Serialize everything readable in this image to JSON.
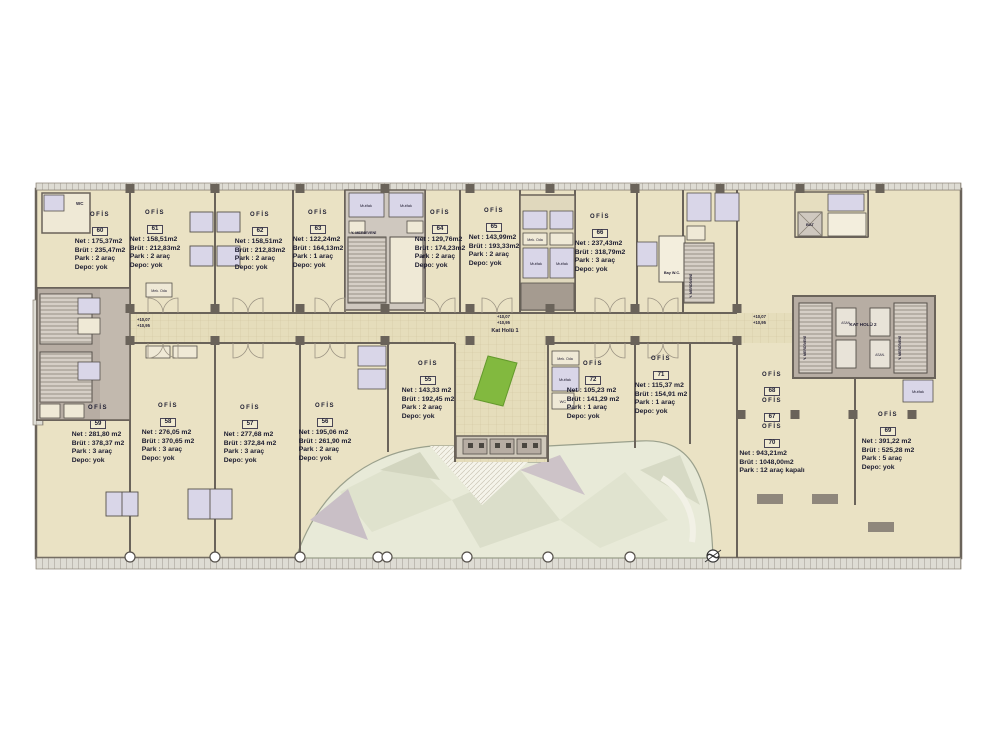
{
  "plan_name": "office-floor-plan",
  "offices": [
    {
      "title": "OFİS",
      "number": "60",
      "net": "Net : 175,37m2",
      "brut": "Brüt : 235,47m2",
      "park": "Park : 2 araç",
      "depo": "Depo: yok"
    },
    {
      "title": "OFİS",
      "number": "61",
      "net": "Net : 158,51m2",
      "brut": "Brüt : 212,83m2",
      "park": "Park : 2 araç",
      "depo": "Depo: yok"
    },
    {
      "title": "OFİS",
      "number": "62",
      "net": "Net : 158,51m2",
      "brut": "Brüt : 212,83m2",
      "park": "Park : 2 araç",
      "depo": "Depo: yok"
    },
    {
      "title": "OFİS",
      "number": "63",
      "net": "Net : 122,24m2",
      "brut": "Brüt : 164,13m2",
      "park": "Park : 1 araç",
      "depo": "Depo: yok"
    },
    {
      "title": "OFİS",
      "number": "64",
      "net": "Net : 129,76m2",
      "brut": "Brüt : 174,23m2",
      "park": "Park : 2 araç",
      "depo": "Depo: yok"
    },
    {
      "title": "OFİS",
      "number": "65",
      "net": "Net : 143,99m2",
      "brut": "Brüt : 193,33m2",
      "park": "Park : 2 araç",
      "depo": "Depo: yok"
    },
    {
      "title": "OFİS",
      "number": "66",
      "net": "Net : 237,43m2",
      "brut": "Brüt : 318,79m2",
      "park": "Park : 3 araç",
      "depo": "Depo: yok"
    },
    {
      "title": "OFİS",
      "number": "59",
      "net": "Net : 281,80 m2",
      "brut": "Brüt : 378,37 m2",
      "park": "Park : 3 araç",
      "depo": "Depo: yok"
    },
    {
      "title": "OFİS",
      "number": "58",
      "net": "Net : 276,05 m2",
      "brut": "Brüt : 370,65 m2",
      "park": "Park : 3 araç",
      "depo": "Depo: yok"
    },
    {
      "title": "OFİS",
      "number": "57",
      "net": "Net : 277,68 m2",
      "brut": "Brüt : 372,84 m2",
      "park": "Park : 3 araç",
      "depo": "Depo: yok"
    },
    {
      "title": "OFİS",
      "number": "56",
      "net": "Net : 195,06 m2",
      "brut": "Brüt : 261,90 m2",
      "park": "Park : 2 araç",
      "depo": "Depo: yok"
    },
    {
      "title": "OFİS",
      "number": "55",
      "net": "Net : 143,33 m2",
      "brut": "Brüt : 192,45 m2",
      "park": "Park : 2 araç",
      "depo": "Depo: yok"
    },
    {
      "title": "OFİS",
      "number": "72",
      "net": "Net : 105,23 m2",
      "brut": "Brüt : 141,29 m2",
      "park": "Park : 1 araç",
      "depo": "Depo: yok"
    },
    {
      "title": "OFİS",
      "number": "71",
      "net": "Net : 115,37 m2",
      "brut": "Brüt : 154,91 m2",
      "park": "Park : 1 araç",
      "depo": "Depo: yok"
    },
    {
      "title": "OFİS",
      "number": "69",
      "net": "Net : 391,22 m2",
      "brut": "Brüt : 525,28 m2",
      "park": "Park : 5 araç",
      "depo": "Depo: yok"
    }
  ],
  "combined": {
    "title": "OFİS",
    "numbers": [
      "68",
      "67",
      "70"
    ],
    "net": "Net : 943,21m2",
    "brut": "Brüt : 1048,00m2",
    "park": "Park : 12 araç kapalı"
  },
  "labels": {
    "hall1": "Kat Holü 1",
    "hall2": "KAT HOLÜ 2",
    "level_a": "+10,07",
    "level_b": "+10,95",
    "stair": "Y. MERDİVENİ",
    "mutfak": "Mutfak",
    "wc": "WC",
    "bay_wc": "Bay W.C.",
    "mek_oda": "Mek. Oda",
    "bat": "BAT",
    "asansor": "ASAN."
  },
  "colors": {
    "building": "#eae2c4",
    "wall": "#6a635a",
    "corridor": "#e5ddbb",
    "service_room": "#d9d6e8",
    "core": "#b7ada3",
    "lawn": "#82b93f",
    "canopy": "#e8ead8"
  }
}
